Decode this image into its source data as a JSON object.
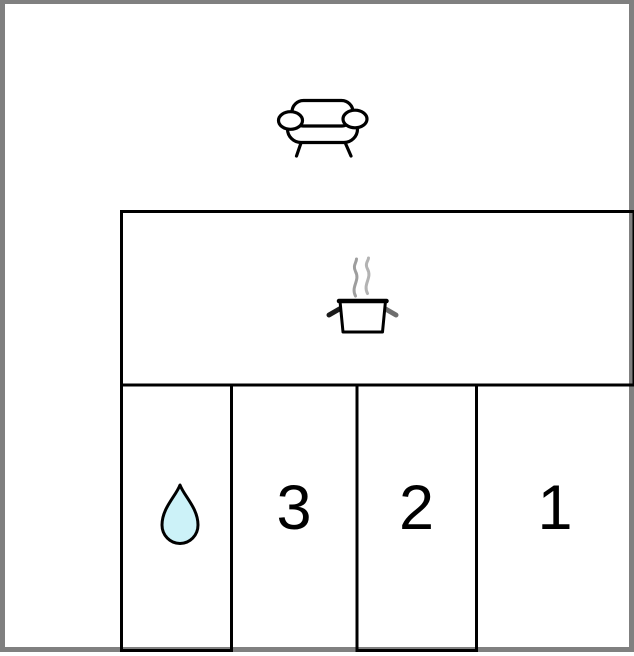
{
  "floor_plan": {
    "living_area": {
      "icon": "sofa-icon"
    },
    "kitchen": {
      "icon": "cooking-pot-icon"
    },
    "rooms": [
      {
        "key": "bathroom",
        "label": "",
        "icon": "water-droplet-icon"
      },
      {
        "key": "room-3",
        "label": "3"
      },
      {
        "key": "room-2",
        "label": "2"
      },
      {
        "key": "room-1",
        "label": "1"
      }
    ],
    "colors": {
      "frame_border": "#808080",
      "walls": "#000000",
      "droplet_fill": "#ccf2f8",
      "steam_gray": "#9e9e9e"
    }
  }
}
